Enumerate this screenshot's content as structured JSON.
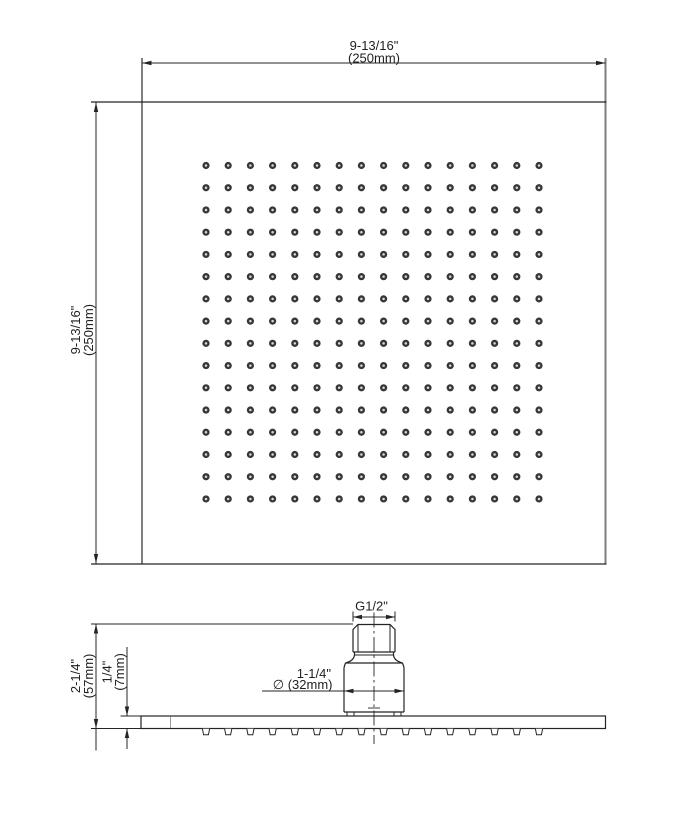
{
  "drawing": {
    "type": "technical_drawing",
    "subject": "square rain shower head - top view and side profile with dimensions",
    "colors": {
      "line": "#242424",
      "square_edge_gray": "#7e7e7e",
      "seam_gray": "#9b9b9b",
      "hole_fill": "#373737",
      "hole_center": "#d9d9d9",
      "background": "#ffffff"
    },
    "top_view": {
      "width_dimension": {
        "imperial": "9-13/16\"",
        "metric": "(250mm)"
      },
      "height_dimension": {
        "imperial": "9-13/16\"",
        "metric": "(250mm)"
      },
      "nozzle_grid": {
        "rows": 16,
        "cols": 16
      }
    },
    "side_view": {
      "thread_label": "G1/2\"",
      "diameter_dimension": {
        "imperial": "1-1/4\"",
        "metric": "∅ (32mm)"
      },
      "overall_height_dimension": {
        "imperial": "2-1/4\"",
        "metric": "(57mm)"
      },
      "plate_thickness_dimension": {
        "imperial": "1/4\"",
        "metric": "(7mm)"
      },
      "nozzle_profile_count": 16
    }
  }
}
